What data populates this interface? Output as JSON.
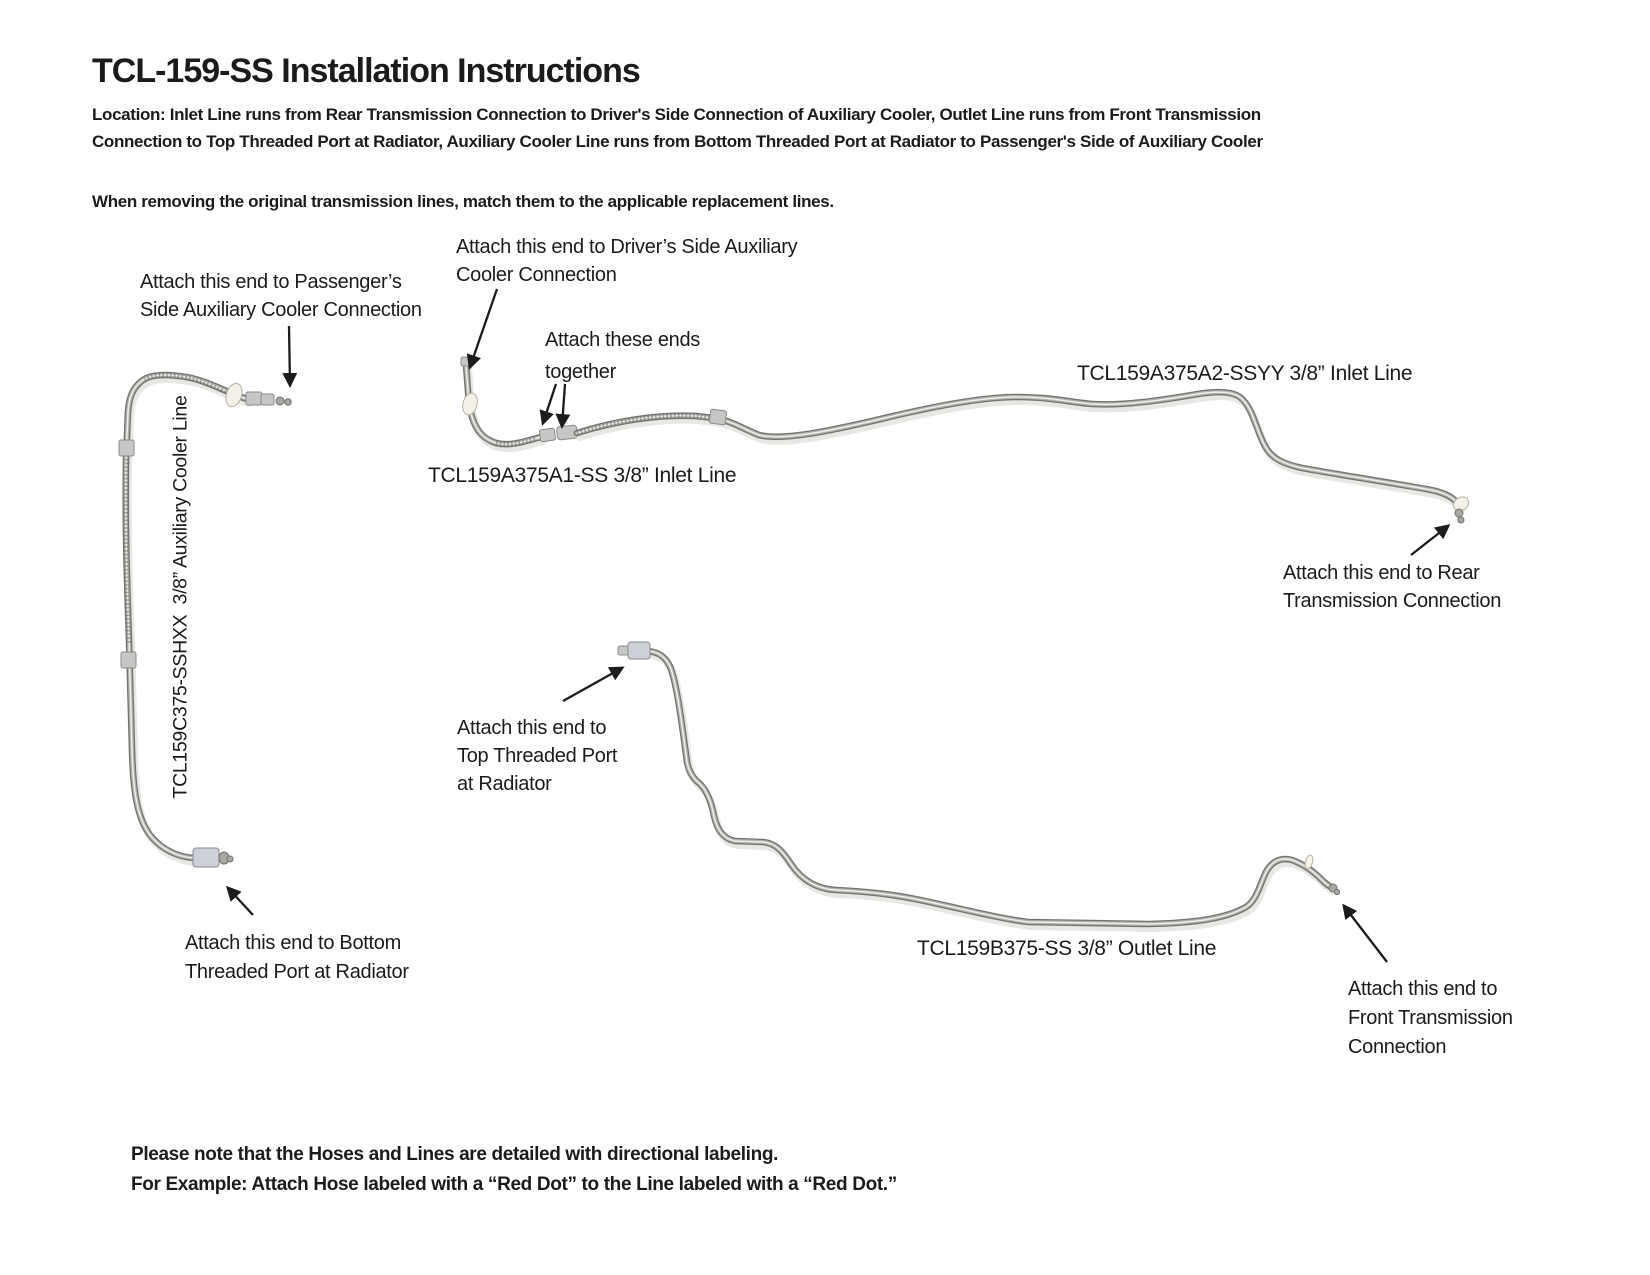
{
  "page": {
    "title": "TCL-159-SS Installation Instructions",
    "location_line1": "Location: Inlet Line runs from Rear Transmission Connection to Driver's Side Connection of Auxiliary Cooler, Outlet Line runs from Front Transmission",
    "location_line2": "Connection to Top Threaded Port at Radiator, Auxiliary Cooler Line runs from Bottom Threaded Port at Radiator to Passenger's Side of Auxiliary Cooler",
    "removal_note": "When removing the original transmission lines, match them to the applicable replacement lines.",
    "footer_line1": "Please note that the Hoses and Lines are detailed with directional labeling.",
    "footer_line2": "For Example: Attach Hose labeled with a “Red Dot” to the Line labeled with a “Red Dot.”"
  },
  "diagram": {
    "labels": {
      "passenger": {
        "line1": "Attach this end to Passenger’s",
        "line2": "Side Auxiliary Cooler Connection"
      },
      "driver": {
        "line1": "Attach this end to Driver’s Side Auxiliary",
        "line2": "Cooler Connection"
      },
      "together": {
        "line1": "Attach these ends",
        "line2": "together"
      },
      "inlet_a2": "TCL159A375A2-SSYY 3/8” Inlet Line",
      "inlet_a1": "TCL159A375A1-SS 3/8” Inlet Line",
      "rear": {
        "line1": "Attach this end to Rear",
        "line2": "Transmission Connection"
      },
      "top_port": {
        "line1": "Attach this end to",
        "line2": "Top Threaded Port",
        "line3": "at Radiator"
      },
      "aux_cooler": "TCL159C375-SSHXX  3/8” Auxiliary Cooler Line",
      "bottom_port": {
        "line1": "Attach this end to Bottom",
        "line2": "Threaded Port at Radiator"
      },
      "outlet_b": "TCL159B375-SS 3/8” Outlet Line",
      "front": {
        "line1": "Attach this end to",
        "line2": "Front Transmission",
        "line3": "Connection"
      }
    },
    "colors": {
      "ink": "#1b1b1b",
      "tube_dark": "#73736f",
      "tube_light": "#ededea",
      "fitting_steel": "#cdd1d7",
      "washer_white": "#f4f1e9"
    }
  }
}
